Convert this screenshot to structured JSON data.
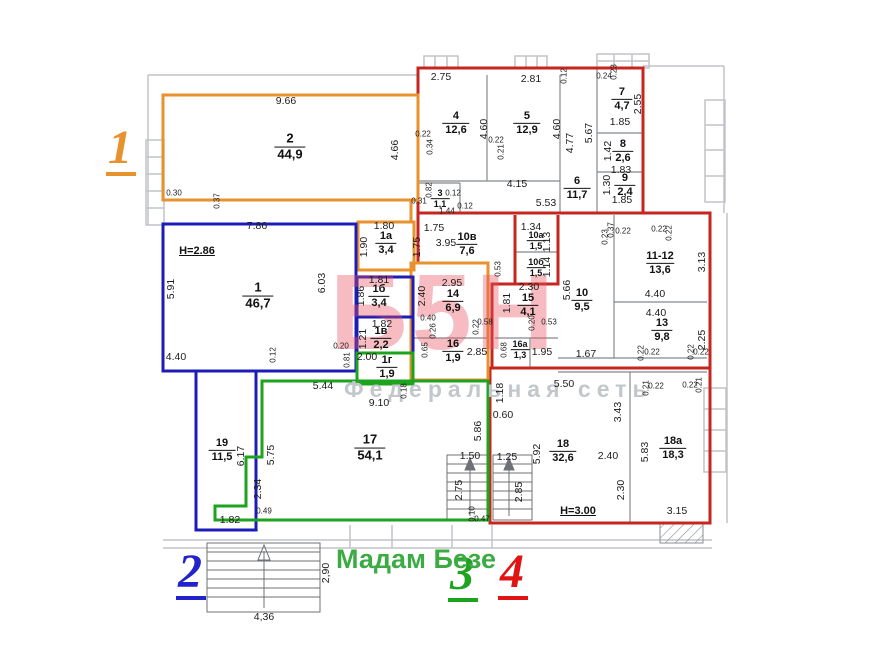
{
  "labels": {
    "unit1": "1",
    "unit2": "2",
    "unit3": "3",
    "unit4": "4",
    "shop_name": "Мадам Безе"
  },
  "watermark": {
    "logo": "Б5Н",
    "tagline": "Федеральная сеть"
  },
  "notes": [
    {
      "t": "H=2.86",
      "x": 197,
      "y": 251
    },
    {
      "t": "H=3.00",
      "x": 578,
      "y": 511
    }
  ],
  "rooms": [
    {
      "n": "2",
      "a": "44,9",
      "x": 290,
      "y": 147,
      "b": 1
    },
    {
      "n": "1",
      "a": "46,7",
      "x": 258,
      "y": 296,
      "b": 1
    },
    {
      "n": "1а",
      "a": "3,4",
      "x": 386,
      "y": 243
    },
    {
      "n": "1б",
      "a": "3,4",
      "x": 379,
      "y": 296
    },
    {
      "n": "1в",
      "a": "2,2",
      "x": 381,
      "y": 338
    },
    {
      "n": "1г",
      "a": "1,9",
      "x": 387,
      "y": 367
    },
    {
      "n": "3",
      "a": "1,1",
      "x": 440,
      "y": 199,
      "s": 1
    },
    {
      "n": "4",
      "a": "12,6",
      "x": 456,
      "y": 123
    },
    {
      "n": "5",
      "a": "12,9",
      "x": 527,
      "y": 123
    },
    {
      "n": "6",
      "a": "11,7",
      "x": 577,
      "y": 188
    },
    {
      "n": "7",
      "a": "4,7",
      "x": 622,
      "y": 99
    },
    {
      "n": "8",
      "a": "2,6",
      "x": 623,
      "y": 151
    },
    {
      "n": "9",
      "a": "2,4",
      "x": 625,
      "y": 185
    },
    {
      "n": "10в",
      "a": "7,6",
      "x": 467,
      "y": 244
    },
    {
      "n": "10а",
      "a": "1,5",
      "x": 536,
      "y": 241,
      "s": 1
    },
    {
      "n": "10б",
      "a": "1,5",
      "x": 536,
      "y": 268,
      "s": 1
    },
    {
      "n": "14",
      "a": "6,9",
      "x": 453,
      "y": 301
    },
    {
      "n": "15",
      "a": "4,1",
      "x": 528,
      "y": 305
    },
    {
      "n": "16",
      "a": "1,9",
      "x": 453,
      "y": 351
    },
    {
      "n": "16а",
      "a": "1,3",
      "x": 520,
      "y": 350,
      "s": 1
    },
    {
      "n": "10",
      "a": "9,5",
      "x": 582,
      "y": 300
    },
    {
      "n": "11-12",
      "a": "13,6",
      "x": 660,
      "y": 263
    },
    {
      "n": "13",
      "a": "9,8",
      "x": 662,
      "y": 330
    },
    {
      "n": "17",
      "a": "54,1",
      "x": 370,
      "y": 448,
      "b": 1
    },
    {
      "n": "18",
      "a": "32,6",
      "x": 563,
      "y": 451
    },
    {
      "n": "18а",
      "a": "18,3",
      "x": 673,
      "y": 448
    },
    {
      "n": "19",
      "a": "11,5",
      "x": 222,
      "y": 450
    }
  ],
  "dims": [
    {
      "t": "9.66",
      "x": 286,
      "y": 101
    },
    {
      "t": "4.66",
      "x": 395,
      "y": 150,
      "v": 1
    },
    {
      "t": "0.30",
      "x": 174,
      "y": 193,
      "s": 1
    },
    {
      "t": "0.37",
      "x": 217,
      "y": 201,
      "v": 1,
      "s": 1
    },
    {
      "t": "7.86",
      "x": 257,
      "y": 226
    },
    {
      "t": "5.91",
      "x": 171,
      "y": 289,
      "v": 1
    },
    {
      "t": "6.03",
      "x": 322,
      "y": 283,
      "v": 1
    },
    {
      "t": "4.40",
      "x": 176,
      "y": 357
    },
    {
      "t": "0.12",
      "x": 273,
      "y": 355,
      "v": 1,
      "s": 1
    },
    {
      "t": "0.20",
      "x": 341,
      "y": 346,
      "s": 1
    },
    {
      "t": "0.81",
      "x": 347,
      "y": 360,
      "v": 1,
      "s": 1
    },
    {
      "t": "1.80",
      "x": 384,
      "y": 226
    },
    {
      "t": "1.90",
      "x": 364,
      "y": 247,
      "v": 1
    },
    {
      "t": "1.81",
      "x": 379,
      "y": 280
    },
    {
      "t": "1.86",
      "x": 361,
      "y": 296,
      "v": 1
    },
    {
      "t": "1.82",
      "x": 382,
      "y": 324
    },
    {
      "t": "1.21",
      "x": 363,
      "y": 339,
      "v": 1
    },
    {
      "t": "2.00",
      "x": 367,
      "y": 357
    },
    {
      "t": "0.18",
      "x": 404,
      "y": 391,
      "v": 1,
      "s": 1
    },
    {
      "t": "2.75",
      "x": 441,
      "y": 77
    },
    {
      "t": "2.81",
      "x": 531,
      "y": 79
    },
    {
      "t": "4.60",
      "x": 484,
      "y": 129,
      "v": 1
    },
    {
      "t": "0.22",
      "x": 423,
      "y": 134,
      "s": 1
    },
    {
      "t": "0.34",
      "x": 430,
      "y": 147,
      "v": 1,
      "s": 1
    },
    {
      "t": "4.60",
      "x": 557,
      "y": 129,
      "v": 1
    },
    {
      "t": "0.22",
      "x": 496,
      "y": 140,
      "s": 1
    },
    {
      "t": "0.21",
      "x": 501,
      "y": 152,
      "v": 1,
      "s": 1
    },
    {
      "t": "4.77",
      "x": 570,
      "y": 143,
      "v": 1
    },
    {
      "t": "5.67",
      "x": 589,
      "y": 133,
      "v": 1
    },
    {
      "t": "4.15",
      "x": 517,
      "y": 184
    },
    {
      "t": "5.53",
      "x": 546,
      "y": 203
    },
    {
      "t": "0.12",
      "x": 564,
      "y": 76,
      "v": 1,
      "s": 1
    },
    {
      "t": "0.24",
      "x": 604,
      "y": 76,
      "s": 1
    },
    {
      "t": "0.23",
      "x": 614,
      "y": 72,
      "v": 1,
      "s": 1
    },
    {
      "t": "2.55",
      "x": 638,
      "y": 104,
      "v": 1
    },
    {
      "t": "1.85",
      "x": 620,
      "y": 122
    },
    {
      "t": "1.42",
      "x": 608,
      "y": 151,
      "v": 1
    },
    {
      "t": "1.83",
      "x": 621,
      "y": 170
    },
    {
      "t": "1.30",
      "x": 607,
      "y": 185,
      "v": 1
    },
    {
      "t": "1.85",
      "x": 622,
      "y": 200
    },
    {
      "t": "0.82",
      "x": 429,
      "y": 190,
      "v": 1,
      "s": 1
    },
    {
      "t": "0.31",
      "x": 419,
      "y": 201,
      "s": 1
    },
    {
      "t": "0.12",
      "x": 453,
      "y": 193,
      "s": 1
    },
    {
      "t": "1.44",
      "x": 447,
      "y": 211,
      "s": 1
    },
    {
      "t": "0.12",
      "x": 465,
      "y": 206,
      "s": 1
    },
    {
      "t": "1.75",
      "x": 434,
      "y": 228
    },
    {
      "t": "3.95",
      "x": 446,
      "y": 243
    },
    {
      "t": "1.75",
      "x": 417,
      "y": 247,
      "v": 1
    },
    {
      "t": "1.34",
      "x": 531,
      "y": 227
    },
    {
      "t": "1.13",
      "x": 547,
      "y": 242,
      "v": 1
    },
    {
      "t": "1.14",
      "x": 547,
      "y": 267,
      "v": 1
    },
    {
      "t": "0.53",
      "x": 498,
      "y": 269,
      "v": 1,
      "s": 1
    },
    {
      "t": "2.95",
      "x": 452,
      "y": 283
    },
    {
      "t": "2.40",
      "x": 422,
      "y": 296,
      "v": 1
    },
    {
      "t": "0.40",
      "x": 428,
      "y": 318,
      "s": 1
    },
    {
      "t": "0.26",
      "x": 433,
      "y": 331,
      "v": 1,
      "s": 1
    },
    {
      "t": "0.22",
      "x": 476,
      "y": 327,
      "v": 1,
      "s": 1
    },
    {
      "t": "0.58",
      "x": 485,
      "y": 322,
      "s": 1
    },
    {
      "t": "0.65",
      "x": 425,
      "y": 350,
      "v": 1,
      "s": 1
    },
    {
      "t": "2.85",
      "x": 477,
      "y": 352
    },
    {
      "t": "2.30",
      "x": 529,
      "y": 287
    },
    {
      "t": "1.81",
      "x": 507,
      "y": 303,
      "v": 1
    },
    {
      "t": "0.20",
      "x": 532,
      "y": 323,
      "v": 1,
      "s": 1
    },
    {
      "t": "0.53",
      "x": 549,
      "y": 322,
      "s": 1
    },
    {
      "t": "0.68",
      "x": 504,
      "y": 350,
      "v": 1,
      "s": 1
    },
    {
      "t": "1.95",
      "x": 542,
      "y": 352
    },
    {
      "t": "5.66",
      "x": 567,
      "y": 290,
      "v": 1
    },
    {
      "t": "1.67",
      "x": 586,
      "y": 354
    },
    {
      "t": "0.23",
      "x": 605,
      "y": 237,
      "v": 1,
      "s": 1
    },
    {
      "t": "0.37",
      "x": 611,
      "y": 230,
      "v": 1,
      "s": 1
    },
    {
      "t": "0.22",
      "x": 623,
      "y": 231,
      "s": 1
    },
    {
      "t": "0.22",
      "x": 659,
      "y": 229,
      "s": 1
    },
    {
      "t": "0.22",
      "x": 669,
      "y": 233,
      "v": 1,
      "s": 1
    },
    {
      "t": "4.40",
      "x": 655,
      "y": 294
    },
    {
      "t": "3.13",
      "x": 702,
      "y": 262,
      "v": 1
    },
    {
      "t": "4.40",
      "x": 656,
      "y": 313
    },
    {
      "t": "2.25",
      "x": 702,
      "y": 340,
      "v": 1
    },
    {
      "t": "0.22",
      "x": 641,
      "y": 353,
      "v": 1,
      "s": 1
    },
    {
      "t": "0.22",
      "x": 652,
      "y": 352,
      "s": 1
    },
    {
      "t": "0.22",
      "x": 691,
      "y": 352,
      "v": 1,
      "s": 1
    },
    {
      "t": "0.22",
      "x": 701,
      "y": 352,
      "s": 1
    },
    {
      "t": "5.44",
      "x": 323,
      "y": 386
    },
    {
      "t": "9.10",
      "x": 379,
      "y": 403
    },
    {
      "t": "5.75",
      "x": 271,
      "y": 455,
      "v": 1
    },
    {
      "t": "6.17",
      "x": 241,
      "y": 456,
      "v": 1
    },
    {
      "t": "2.34",
      "x": 258,
      "y": 489,
      "v": 1
    },
    {
      "t": "0.49",
      "x": 264,
      "y": 511,
      "s": 1
    },
    {
      "t": "1.82",
      "x": 230,
      "y": 520
    },
    {
      "t": "5.86",
      "x": 478,
      "y": 431,
      "v": 1
    },
    {
      "t": "1.50",
      "x": 470,
      "y": 456
    },
    {
      "t": "2.75",
      "x": 459,
      "y": 490,
      "v": 1
    },
    {
      "t": "0.10",
      "x": 472,
      "y": 514,
      "v": 1,
      "s": 1
    },
    {
      "t": "0.47",
      "x": 482,
      "y": 519,
      "s": 1
    },
    {
      "t": "5.50",
      "x": 564,
      "y": 384
    },
    {
      "t": "1.18",
      "x": 500,
      "y": 393,
      "v": 1
    },
    {
      "t": "0.60",
      "x": 503,
      "y": 415
    },
    {
      "t": "3.43",
      "x": 618,
      "y": 412,
      "v": 1
    },
    {
      "t": "5.92",
      "x": 537,
      "y": 454,
      "v": 1
    },
    {
      "t": "2.40",
      "x": 608,
      "y": 456
    },
    {
      "t": "2.30",
      "x": 621,
      "y": 490,
      "v": 1
    },
    {
      "t": "1.25",
      "x": 507,
      "y": 457
    },
    {
      "t": "2.85",
      "x": 519,
      "y": 492,
      "v": 1
    },
    {
      "t": "5.83",
      "x": 645,
      "y": 452,
      "v": 1
    },
    {
      "t": "3.15",
      "x": 677,
      "y": 511
    },
    {
      "t": "0.21",
      "x": 646,
      "y": 388,
      "v": 1,
      "s": 1
    },
    {
      "t": "0.22",
      "x": 656,
      "y": 386,
      "s": 1
    },
    {
      "t": "0.22",
      "x": 690,
      "y": 385,
      "s": 1
    },
    {
      "t": "0.21",
      "x": 699,
      "y": 385,
      "v": 1,
      "s": 1
    },
    {
      "t": "4,36",
      "x": 264,
      "y": 617
    },
    {
      "t": "2,90",
      "x": 326,
      "y": 573,
      "v": 1
    }
  ]
}
